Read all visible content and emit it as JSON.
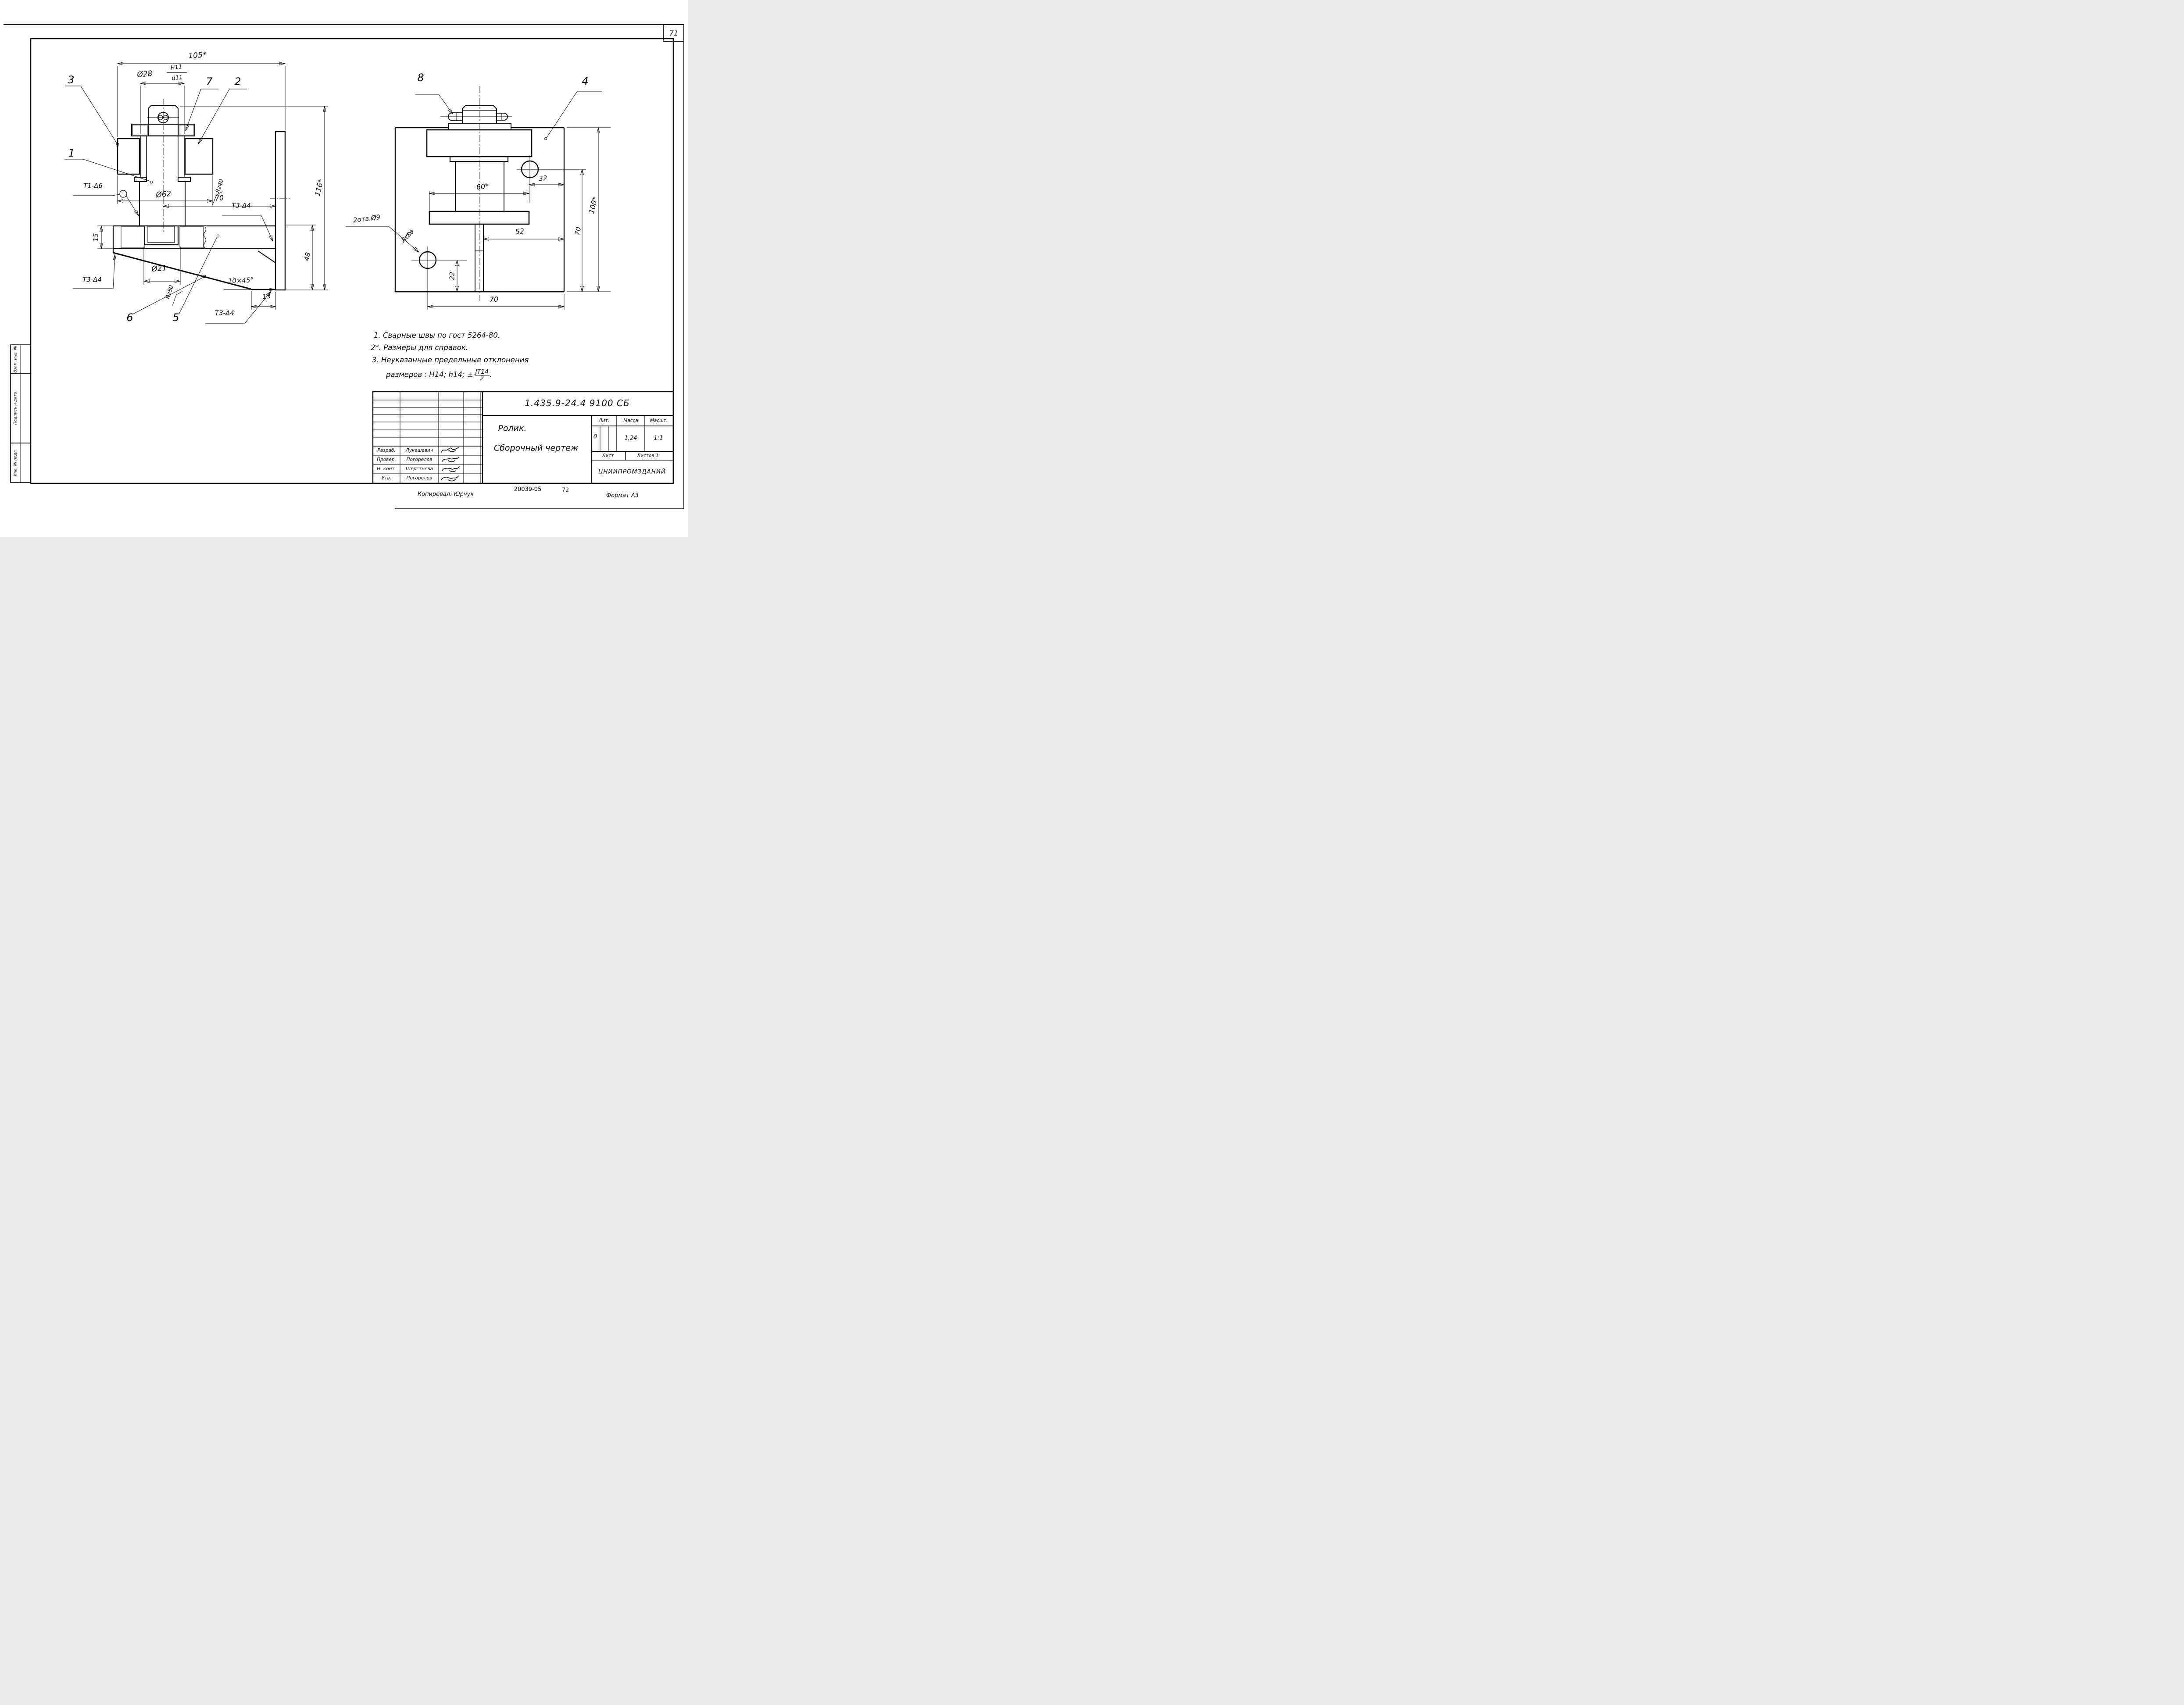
{
  "page": {
    "number": "71"
  },
  "sidebar": {
    "items": [
      "Взам. инв. №",
      "Подпись и дата",
      "Инв. № подл."
    ]
  },
  "left_view": {
    "part_labels": {
      "p1": "1",
      "p2": "2",
      "p3": "3",
      "p5": "5",
      "p6": "6",
      "p7": "7"
    },
    "dims": {
      "width_overall": "105*",
      "bore": "Ø28",
      "fit_num": "H11",
      "fit_den": "d11",
      "roller_dia": "Ø62",
      "axis_offset": "70",
      "slot_dia": "Ø21",
      "plate_thick": "15",
      "chamfer": "10×45°",
      "foot": "15",
      "height_48": "48",
      "height_overall": "116*"
    },
    "welds": {
      "t1": "Т1-Δ6",
      "t3a": "Т3-Δ4",
      "t3b": "Т3-Δ4",
      "t3c": "Т3-Δ4"
    },
    "surface": {
      "rz40": "Rz40",
      "rz80": "Rz80"
    }
  },
  "right_view": {
    "part_labels": {
      "p4": "4",
      "p8": "8"
    },
    "dims": {
      "width_60": "60*",
      "hole_offset": "32",
      "offset_52": "52",
      "hole_height": "22",
      "width_70": "70",
      "height_70": "70",
      "height_100": "100*"
    },
    "holes_note": "2отв.Ø9",
    "surface": {
      "rz80": "Rz80"
    }
  },
  "notes": {
    "line1": "1. Сварные швы по гост 5264-80.",
    "line2": "2*. Размеры для справок.",
    "line3": "3. Неуказанные предельные отклонения",
    "line4_prefix": "размеров : Н14; h14; ±",
    "line4_frac_num": "JT14",
    "line4_frac_den": "2",
    "line4_suffix": "."
  },
  "title_block": {
    "doc_number": "1.435.9-24.4 9100 СБ",
    "title_line1": "Ролик.",
    "title_line2": "Сборочный чертеж",
    "headers": {
      "lit": "Лит.",
      "mass": "Масса",
      "scale": "Масшт.",
      "sheet": "Лист",
      "sheets": "Листов 1"
    },
    "values": {
      "lit": "0",
      "mass": "1,24",
      "scale": "1:1"
    },
    "org": "ЦНИИПРОМЗДАНИЙ",
    "rows": [
      {
        "role": "Разраб.",
        "name": "Лукашевич"
      },
      {
        "role": "Провер.",
        "name": "Погорелов"
      },
      {
        "role": "Н. конт.",
        "name": "Шерстнева"
      },
      {
        "role": "Утв.",
        "name": "Погорелов"
      }
    ]
  },
  "footer": {
    "copied": "Копировал: Юрчук",
    "code": "20039-05",
    "ref": "72",
    "format": "Формат А3"
  }
}
